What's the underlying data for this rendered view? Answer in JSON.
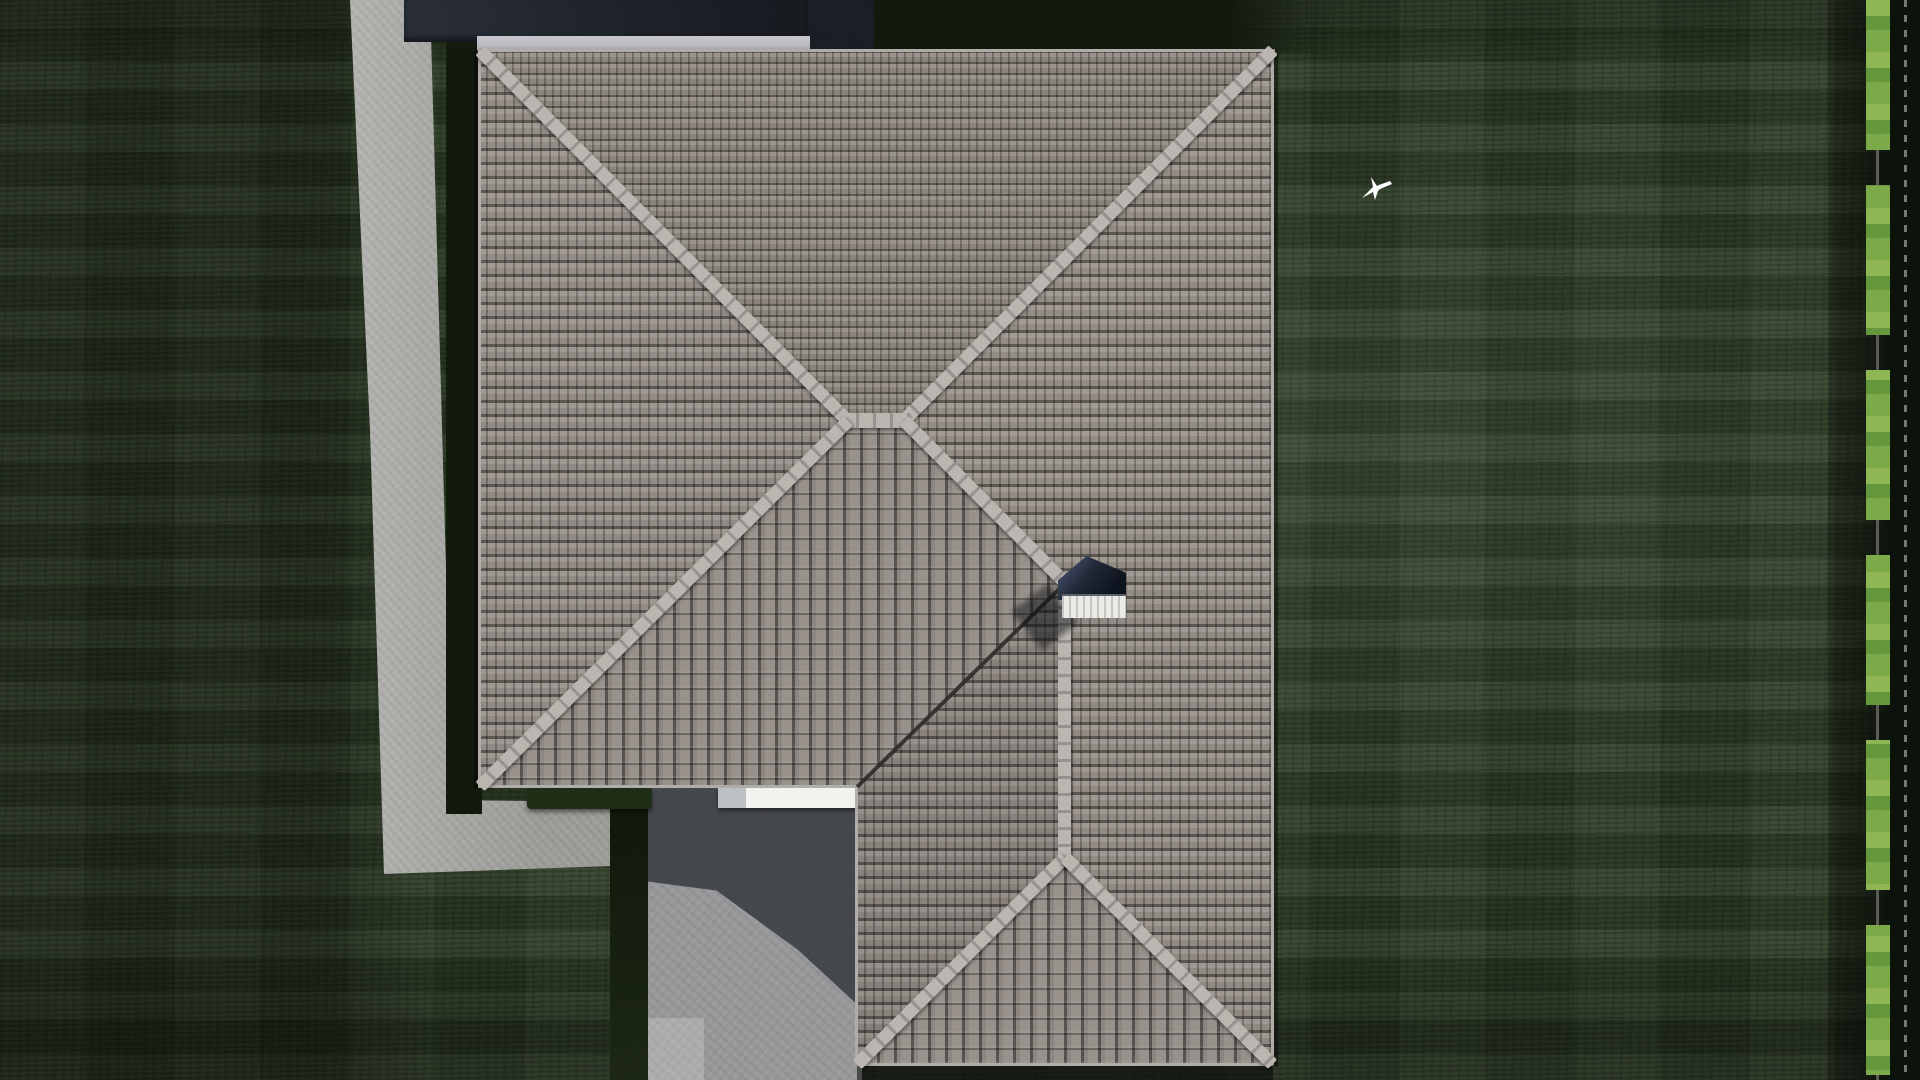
{
  "watermark": {
    "parts": [
      {
        "t": "F",
        "c": "#3b7de2"
      },
      {
        "t": "ix",
        "c": "#f3f5f7"
      },
      {
        "t": "P",
        "c": "#4bb42f"
      },
      {
        "t": "lans",
        "c": "#f3f5f7"
      },
      {
        "t": ".",
        "c": "#3b7de2"
      },
      {
        "t": "ru",
        "c": "#f3f5f7"
      }
    ]
  },
  "palette": {
    "grass": "#2c3b24",
    "grassShadow": "#10180c",
    "path": "#a7a7a3",
    "pad": "#8e9092",
    "padShadow": "#35383e",
    "tileMid": "#8d8580",
    "tileLight": "#a59d96",
    "tileDark": "#5b5652",
    "ridge": "#b5b0aa",
    "ridgeTick": "#8f8a85",
    "valley": "#2a2826",
    "band": "#20242b",
    "fascia": "#b5b5bb",
    "hedge": "#7cab49",
    "hedgeDark": "#1c2a14",
    "beam": "#f1f1ee",
    "chimDark": "#1d2431",
    "chimBase": "#e9e9e6",
    "bird": "#ffffff"
  },
  "scene": {
    "chimney_vent_holes": 4,
    "palm_count": 6,
    "bird": "white-bird-in-flight"
  },
  "markers": {
    "top": {
      "dashes": [
        {
          "c": "#4fb22f",
          "w": 14,
          "h": 8,
          "g": 9
        },
        {
          "c": "#f5f6f3",
          "w": 22,
          "h": 9,
          "g": 10
        },
        {
          "c": "#f5f6f3",
          "w": 24,
          "h": 9,
          "g": 10
        },
        {
          "c": "#2f6fd8",
          "w": 16,
          "h": 9,
          "g": 10
        },
        {
          "c": "#f5f6f3",
          "w": 22,
          "h": 9,
          "g": 10
        },
        {
          "c": "#f5f6f3",
          "w": 26,
          "h": 9,
          "g": 10
        },
        {
          "c": "#4fb22f",
          "w": 40,
          "h": 10,
          "g": 10
        },
        {
          "c": "#f5f6f3",
          "w": 22,
          "h": 9,
          "g": 10
        },
        {
          "c": "#f5f6f3",
          "w": 18,
          "h": 8,
          "g": 10
        },
        {
          "c": "#f5f6f3",
          "w": 14,
          "h": 8,
          "g": 10
        }
      ]
    },
    "bottom": {
      "dashes": [
        {
          "c": "#3ec1e8",
          "w": 30,
          "h": 21,
          "g": 8,
          "rot": -12
        },
        {
          "c": "#4fb22f",
          "w": 13,
          "h": 10,
          "g": 9
        },
        {
          "c": "#f5f6f3",
          "w": 26,
          "h": 10,
          "g": 10
        },
        {
          "c": "#f5f6f3",
          "w": 22,
          "h": 10,
          "g": 10
        },
        {
          "c": "#4fb22f",
          "w": 36,
          "h": 12,
          "g": 10
        },
        {
          "c": "#f5f6f3",
          "w": 26,
          "h": 10,
          "g": 10
        },
        {
          "c": "#f5f6f3",
          "w": 24,
          "h": 10,
          "g": 10
        },
        {
          "c": "#f5f6f3",
          "w": 22,
          "h": 9,
          "g": 10
        },
        {
          "c": "#3ec1e8",
          "w": 14,
          "h": 9,
          "g": 10
        },
        {
          "c": "#f5f6f3",
          "w": 20,
          "h": 9,
          "g": 10
        },
        {
          "c": "#f5f6f3",
          "w": 16,
          "h": 8,
          "g": 10
        }
      ]
    }
  }
}
